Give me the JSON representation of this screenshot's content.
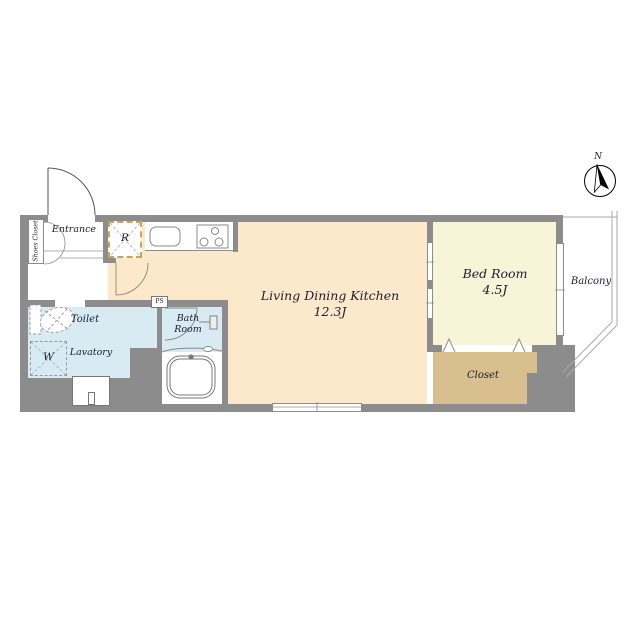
{
  "floor_plan": {
    "rooms": {
      "ldk": {
        "name": "Living Dining Kitchen",
        "size": "12.3J"
      },
      "bedroom": {
        "name": "Bed Room",
        "size": "4.5J"
      },
      "closet": {
        "label": "Closet"
      },
      "balcony": {
        "label": "Balcony"
      },
      "toilet": {
        "label": "Toilet"
      },
      "lavatory": {
        "label": "Lavatory"
      },
      "bathroom": {
        "label": "Bath Room"
      },
      "entrance": {
        "label": "Entrance"
      },
      "shoes_closet": {
        "label": "Shoes Closet"
      }
    },
    "markers": {
      "refrigerator": "R",
      "washer": "W",
      "pipe_space": "PS",
      "north": "N"
    },
    "colors": {
      "wall": "#8c8c8c",
      "ldk_floor": "#fce9cc",
      "bedroom_floor": "#f8f4d7",
      "closet_floor": "#d8bf8d",
      "wet_area_floor": "#d8ebf3",
      "refrigerator_dash": "#c9a268",
      "text": "#1d1d35"
    }
  }
}
